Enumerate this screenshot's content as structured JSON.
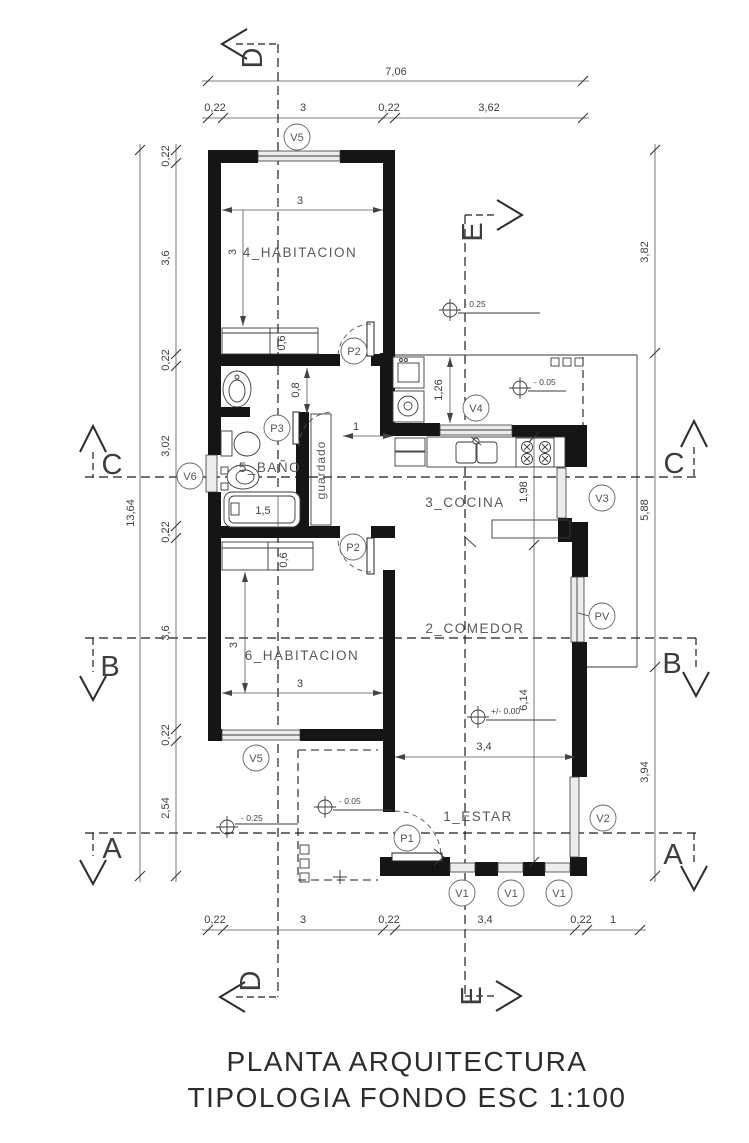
{
  "title": {
    "line1": "PLANTA ARQUITECTURA",
    "line2": "TIPOLOGIA FONDO ESC 1:100"
  },
  "rooms": {
    "hab4": "4_HABITACION",
    "bano": "5_BAÑO",
    "cocina": "3_COCINA",
    "comedor": "2_COMEDOR",
    "hab6": "6_HABITACION",
    "estar": "1_ESTAR",
    "guardado": "guardado"
  },
  "tags": {
    "v5_top": "V5",
    "v6": "V6",
    "v4": "V4",
    "v3": "V3",
    "pv": "PV",
    "v2": "V2",
    "v5_bottom": "V5",
    "v1_a": "V1",
    "v1_b": "V1",
    "v1_c": "V1",
    "p1": "P1",
    "p2_upper": "P2",
    "p2_lower": "P2",
    "p3": "P3"
  },
  "sections": {
    "a": "A",
    "b": "B",
    "c": "C",
    "d": "D",
    "e": "E"
  },
  "dims": {
    "top_total": "7,06",
    "top_row": [
      "0,22",
      "3",
      "0,22",
      "3,62"
    ],
    "bottom_row": [
      "0,22",
      "3",
      "0,22",
      "3,4",
      "0,22",
      "1"
    ],
    "left_total": "13,64",
    "left_row": [
      "0,22",
      "3,6",
      "0,22",
      "3,02",
      "0,22",
      "3,6",
      "0,22",
      "2,54"
    ],
    "right_row": [
      "3,82",
      "5,88",
      "3,94"
    ],
    "interior": {
      "hab4_w": "3",
      "hab4_h": "3",
      "closet4": "0,6",
      "pass": "0,8",
      "hall": "1",
      "tub": "1,5",
      "lav": "1,26",
      "kitchen": "1,98",
      "estar_h": "6,14",
      "estar_w": "3,4",
      "hab6_w": "3",
      "hab6_h": "3",
      "closet6": "0,6"
    }
  },
  "levels": {
    "patio_top": "- 0.25",
    "galeria": "- 0.05",
    "estar": "+/- 0.00",
    "porch": "- 0.05",
    "garden": "- 0.25"
  }
}
